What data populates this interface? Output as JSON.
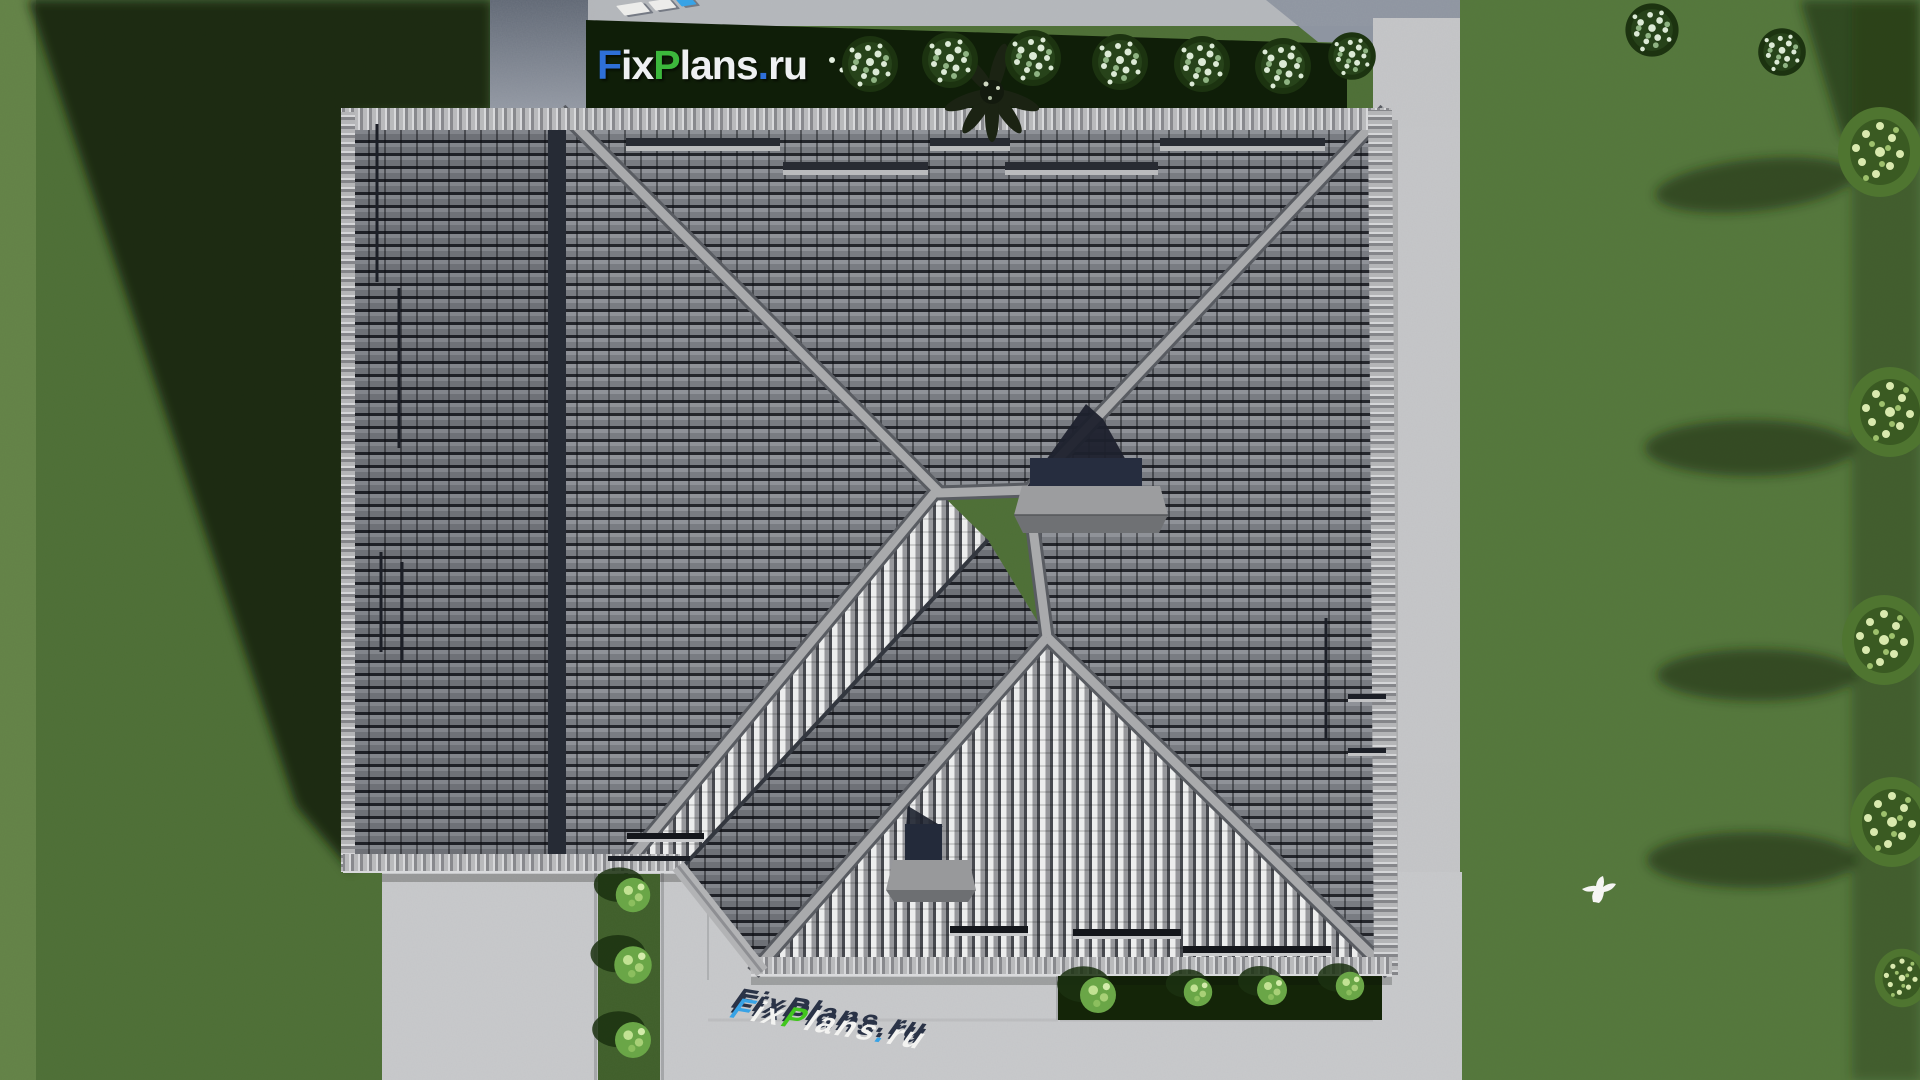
{
  "page": {
    "description": "Aerial top-down 3D render of a hip roof house plan with lawn, pavements, hedges and trees",
    "watermark_full_text": "FixPlans.ru"
  },
  "logo": {
    "segments": [
      {
        "text": "F",
        "color": "#2e6fd8"
      },
      {
        "text": "ix",
        "color": "#eef0f2"
      },
      {
        "text": "P",
        "color": "#3cb83c"
      },
      {
        "text": "lans",
        "color": "#eef0f2"
      },
      {
        "text": ".",
        "color": "#2e6fd8"
      },
      {
        "text": "ru",
        "color": "#eef0f2"
      }
    ]
  },
  "watermark_bottom": {
    "segments": [
      {
        "text": "F",
        "color": "#38a3e6"
      },
      {
        "text": "ix",
        "color": "#f3f3f1"
      },
      {
        "text": "P",
        "color": "#41c61e"
      },
      {
        "text": "lans",
        "color": "#f3f3f1"
      },
      {
        "text": ".",
        "color": "#38a3e6"
      },
      {
        "text": "ru",
        "color": "#f3f3f1"
      }
    ]
  },
  "watermark_top_partial": {
    "blocks": [
      {
        "color": "#ececea"
      },
      {
        "color": "#ececea"
      },
      {
        "color": "#38a3e6"
      }
    ]
  },
  "colors": {
    "wm_shadow": "#2a3347",
    "accent_blue": "#2e6fd8",
    "accent_green": "#3cb83c",
    "lawn": "#4e7036",
    "lawn_shadow": "#142608",
    "pavement": "#c9cacc",
    "path_shadowed": "#5f6774",
    "roof_dark_tile": "#7a7d83",
    "roof_light_tile": "#ececea",
    "hedge": "#0f1e08",
    "chimney_body": "#262d3f"
  }
}
